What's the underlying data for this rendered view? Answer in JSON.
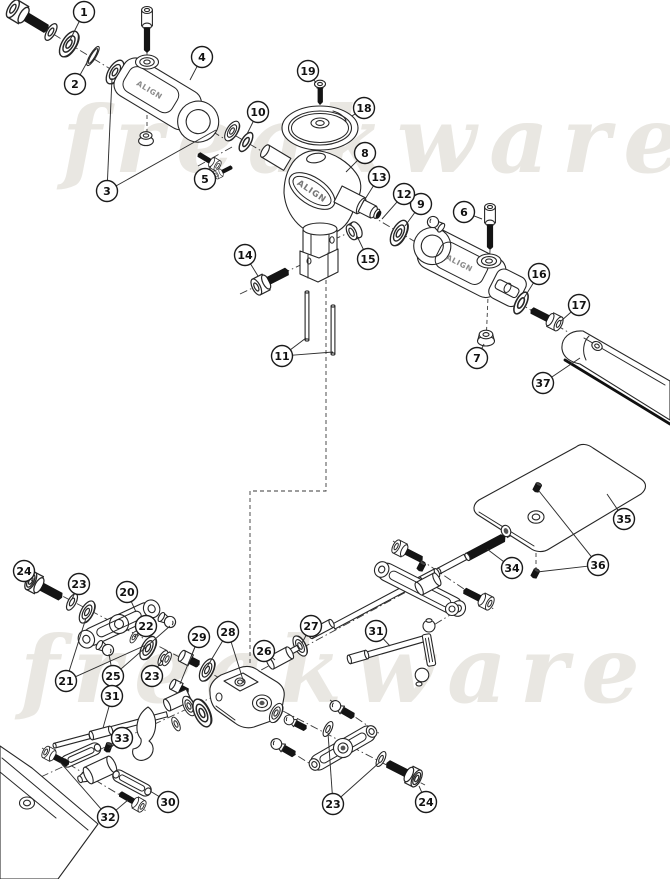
{
  "watermark": {
    "text": "freakware",
    "color": "#e9e7e2"
  },
  "labels": {
    "brand": "ALIGN"
  },
  "callouts": [
    {
      "n": "1",
      "x": 84,
      "y": 12,
      "targets": [
        [
          70,
          40
        ]
      ]
    },
    {
      "n": "2",
      "x": 75,
      "y": 84,
      "targets": [
        [
          90,
          57
        ]
      ]
    },
    {
      "n": "3",
      "x": 107,
      "y": 191,
      "targets": [
        [
          112,
          78
        ],
        [
          216,
          130
        ]
      ]
    },
    {
      "n": "4",
      "x": 202,
      "y": 57,
      "targets": [
        [
          190,
          80
        ]
      ]
    },
    {
      "n": "5",
      "x": 205,
      "y": 179,
      "targets": [
        [
          211,
          166
        ]
      ]
    },
    {
      "n": "6",
      "x": 464,
      "y": 212,
      "targets": [
        [
          482,
          219
        ]
      ]
    },
    {
      "n": "7",
      "x": 477,
      "y": 358,
      "targets": [
        [
          484,
          344
        ]
      ]
    },
    {
      "n": "8",
      "x": 365,
      "y": 153,
      "targets": [
        [
          346,
          172
        ]
      ]
    },
    {
      "n": "9",
      "x": 421,
      "y": 204,
      "targets": [
        [
          405,
          226
        ]
      ]
    },
    {
      "n": "10",
      "x": 258,
      "y": 112,
      "targets": [
        [
          247,
          134
        ]
      ]
    },
    {
      "n": "11",
      "x": 282,
      "y": 356,
      "targets": [
        [
          306,
          338
        ],
        [
          333,
          352
        ]
      ]
    },
    {
      "n": "12",
      "x": 404,
      "y": 194,
      "targets": [
        [
          382,
          219
        ]
      ]
    },
    {
      "n": "13",
      "x": 379,
      "y": 177,
      "targets": [
        [
          362,
          204
        ]
      ]
    },
    {
      "n": "14",
      "x": 245,
      "y": 255,
      "targets": [
        [
          258,
          276
        ]
      ]
    },
    {
      "n": "15",
      "x": 368,
      "y": 259,
      "targets": [
        [
          357,
          236
        ]
      ]
    },
    {
      "n": "16",
      "x": 539,
      "y": 274,
      "targets": [
        [
          524,
          298
        ]
      ]
    },
    {
      "n": "17",
      "x": 579,
      "y": 305,
      "targets": [
        [
          561,
          321
        ]
      ]
    },
    {
      "n": "18",
      "x": 364,
      "y": 108,
      "targets": [
        [
          352,
          116
        ]
      ]
    },
    {
      "n": "19",
      "x": 308,
      "y": 71,
      "targets": [
        [
          316,
          83
        ]
      ]
    },
    {
      "n": "20",
      "x": 127,
      "y": 592,
      "targets": [
        [
          136,
          612
        ]
      ]
    },
    {
      "n": "21",
      "x": 66,
      "y": 681,
      "targets": [
        [
          86,
          618
        ],
        [
          146,
          645
        ]
      ]
    },
    {
      "n": "22",
      "x": 146,
      "y": 626,
      "targets": [
        [
          134,
          637
        ]
      ]
    },
    {
      "n": "23",
      "x": 79,
      "y": 584,
      "targets": [
        [
          72,
          599
        ]
      ]
    },
    {
      "n": "23",
      "x": 152,
      "y": 676,
      "targets": [
        [
          162,
          660
        ]
      ]
    },
    {
      "n": "23",
      "x": 333,
      "y": 804,
      "targets": [
        [
          328,
          733
        ],
        [
          380,
          762
        ]
      ]
    },
    {
      "n": "24",
      "x": 24,
      "y": 571,
      "targets": [
        [
          33,
          582
        ]
      ]
    },
    {
      "n": "24",
      "x": 426,
      "y": 802,
      "targets": [
        [
          419,
          786
        ]
      ]
    },
    {
      "n": "25",
      "x": 113,
      "y": 676,
      "targets": [
        [
          109,
          654
        ],
        [
          170,
          626
        ]
      ]
    },
    {
      "n": "26",
      "x": 264,
      "y": 651,
      "targets": [
        [
          275,
          660
        ]
      ]
    },
    {
      "n": "27",
      "x": 311,
      "y": 626,
      "targets": [
        [
          302,
          643
        ]
      ]
    },
    {
      "n": "28",
      "x": 228,
      "y": 632,
      "targets": [
        [
          207,
          667
        ],
        [
          244,
          683
        ]
      ]
    },
    {
      "n": "29",
      "x": 199,
      "y": 637,
      "targets": [
        [
          191,
          657
        ],
        [
          180,
          684
        ]
      ]
    },
    {
      "n": "30",
      "x": 168,
      "y": 802,
      "targets": [
        [
          150,
          791
        ]
      ]
    },
    {
      "n": "31",
      "x": 112,
      "y": 696,
      "targets": [
        [
          103,
          728
        ]
      ]
    },
    {
      "n": "31",
      "x": 376,
      "y": 631,
      "targets": [
        [
          390,
          646
        ]
      ]
    },
    {
      "n": "32",
      "x": 108,
      "y": 817,
      "targets": [
        [
          60,
          762
        ],
        [
          128,
          800
        ]
      ]
    },
    {
      "n": "33",
      "x": 122,
      "y": 738,
      "targets": [
        [
          109,
          749
        ]
      ]
    },
    {
      "n": "34",
      "x": 512,
      "y": 568,
      "targets": [
        [
          487,
          549
        ]
      ]
    },
    {
      "n": "35",
      "x": 624,
      "y": 519,
      "targets": [
        [
          607,
          494
        ]
      ]
    },
    {
      "n": "36",
      "x": 598,
      "y": 565,
      "targets": [
        [
          539,
          491
        ],
        [
          537,
          572
        ]
      ]
    },
    {
      "n": "37",
      "x": 543,
      "y": 383,
      "targets": [
        [
          580,
          358
        ]
      ]
    }
  ]
}
